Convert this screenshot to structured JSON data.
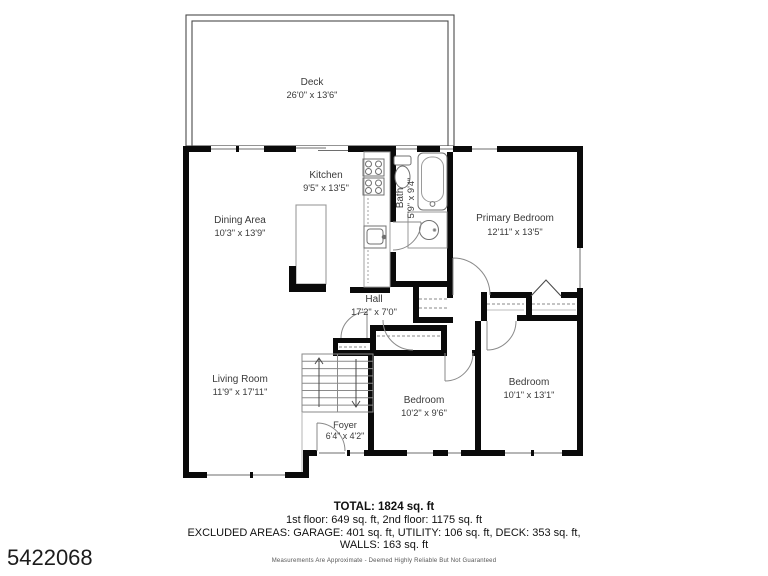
{
  "page": {
    "listing_id": "5422068",
    "disclaimer": "Measurements Are Approximate - Deemed Highly Reliable But Not Guaranteed"
  },
  "summary": {
    "total": "TOTAL: 1824 sq. ft",
    "floors": "1st floor: 649 sq. ft, 2nd floor: 1175 sq. ft",
    "excluded_areas": "EXCLUDED AREAS: GARAGE: 401 sq. ft, UTILITY: 106 sq. ft, DECK: 353 sq. ft,",
    "walls": "WALLS: 163 sq. ft"
  },
  "rooms": {
    "deck": {
      "name": "Deck",
      "dims": "26'0\" x 13'6\""
    },
    "kitchen": {
      "name": "Kitchen",
      "dims": "9'5\" x 13'5\""
    },
    "dining": {
      "name": "Dining Area",
      "dims": "10'3\" x 13'9\""
    },
    "bath": {
      "name": "Bath",
      "dims": "5'9\" x 9'4\""
    },
    "primary_bedroom": {
      "name": "Primary Bedroom",
      "dims": "12'11\" x 13'5\""
    },
    "hall": {
      "name": "Hall",
      "dims": "17'2\" x 7'0\""
    },
    "living": {
      "name": "Living Room",
      "dims": "11'9\" x 17'11\""
    },
    "bedroom_center": {
      "name": "Bedroom",
      "dims": "10'2\" x 9'6\""
    },
    "bedroom_right": {
      "name": "Bedroom",
      "dims": "10'1\" x 13'1\""
    },
    "foyer": {
      "name": "Foyer",
      "dims": "6'4\" x 4'2\""
    }
  },
  "colors": {
    "wall": "#0a0a0a",
    "fixture": "#8f8f8f",
    "label": "#3a3a3a",
    "background": "#ffffff"
  }
}
